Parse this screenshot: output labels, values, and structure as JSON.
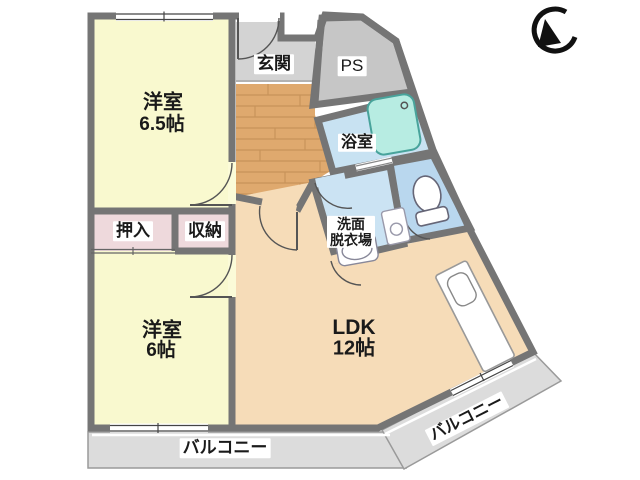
{
  "plan_title": "apartment-floor-plan",
  "compass": {
    "icon": "north-arrow"
  },
  "rooms": {
    "bedroom1": {
      "name": "洋室",
      "size": "6.5帖"
    },
    "bedroom2": {
      "name": "洋室",
      "size": "6帖"
    },
    "ldk": {
      "name": "LDK",
      "size": "12帖"
    },
    "entrance": {
      "label": "玄関"
    },
    "pipe_space": {
      "label": "PS"
    },
    "bath": {
      "label": "浴室"
    },
    "washroom": {
      "line1": "洗面",
      "line2": "脱衣場"
    },
    "closet": {
      "label": "押入"
    },
    "storage": {
      "label": "収納"
    },
    "balcony_south": {
      "label": "バルコニー"
    },
    "balcony_east": {
      "label": "バルコニー"
    }
  },
  "colors": {
    "wall": "#757575",
    "room_yellow": "#f9f9cf",
    "ldk_peach": "#f6dcb8",
    "closet_pink": "#eed9dc",
    "wood": "#dfa96e",
    "wood_line": "#c8935a",
    "entrance_gray": "#d3d3d3",
    "ps_gray": "#c6c6c6",
    "bath_blue": "#c8e2f2",
    "toilet_blue": "#b9d7ee",
    "washroom_blue": "#cbe3f3",
    "tub_cyan": "#b7ece2",
    "balcony_gray": "#dcdcdc"
  }
}
